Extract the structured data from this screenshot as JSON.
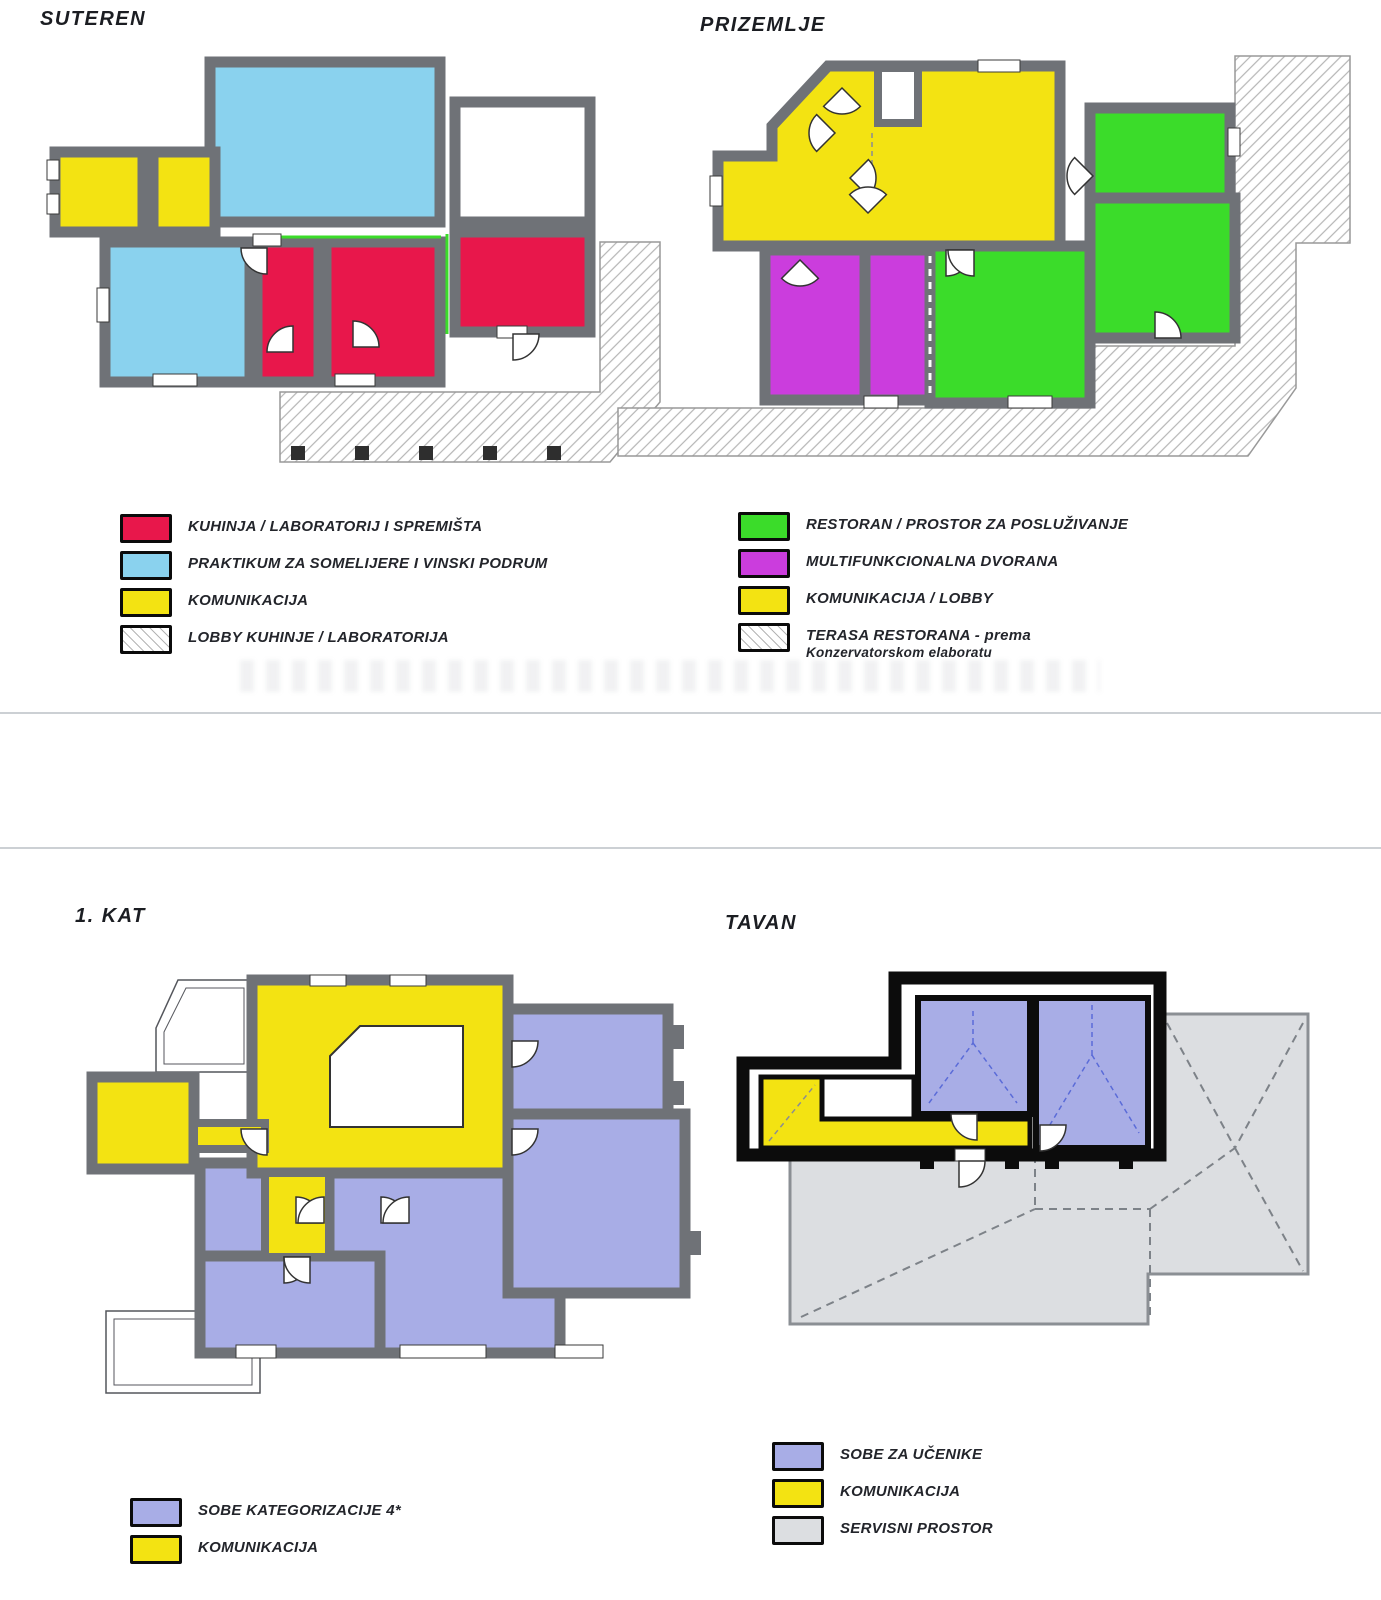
{
  "page": {
    "background": "#ffffff",
    "divider_color": "#ccd0d4"
  },
  "colors": {
    "red": "#e8174b",
    "skyblue": "#8ad2ee",
    "yellow": "#f3e312",
    "green": "#3bdc2a",
    "magenta": "#cb3ddd",
    "periwinkle": "#a8ade6",
    "roofgray": "#dcdee1",
    "wall": "#6f7277",
    "black": "#0c0c0c",
    "hatch": "#b5b5b5",
    "divider": "#ccd0d4",
    "white": "#ffffff"
  },
  "plans": {
    "suteren": {
      "title": "SUTEREN",
      "legend": [
        {
          "color": "red",
          "label": "KUHINJA / LABORATORIJ I SPREMIŠTA"
        },
        {
          "color": "skyblue",
          "label": "PRAKTIKUM ZA SOMELIJERE I VINSKI PODRUM"
        },
        {
          "color": "yellow",
          "label": "KOMUNIKACIJA"
        },
        {
          "color": "hatched",
          "label": "LOBBY KUHINJE / LABORATORIJA"
        }
      ]
    },
    "prizemlje": {
      "title": "PRIZEMLJE",
      "legend": [
        {
          "color": "green",
          "label": "RESTORAN / PROSTOR ZA POSLUŽIVANJE"
        },
        {
          "color": "magenta",
          "label": "MULTIFUNKCIONALNA DVORANA"
        },
        {
          "color": "yellow",
          "label": "KOMUNIKACIJA / LOBBY"
        },
        {
          "color": "hatched",
          "label": "TERASA RESTORANA - prema",
          "label2": "Konzervatorskom elaboratu"
        }
      ]
    },
    "kat1": {
      "title": "1. KAT",
      "legend": [
        {
          "color": "periwinkle",
          "label": "SOBE KATEGORIZACIJE 4*"
        },
        {
          "color": "yellow",
          "label": "KOMUNIKACIJA"
        }
      ]
    },
    "tavan": {
      "title": "TAVAN",
      "legend": [
        {
          "color": "periwinkle",
          "label": "SOBE ZA UČENIKE"
        },
        {
          "color": "yellow",
          "label": "KOMUNIKACIJA"
        },
        {
          "color": "roofgray",
          "label": "SERVISNI PROSTOR"
        }
      ]
    }
  }
}
